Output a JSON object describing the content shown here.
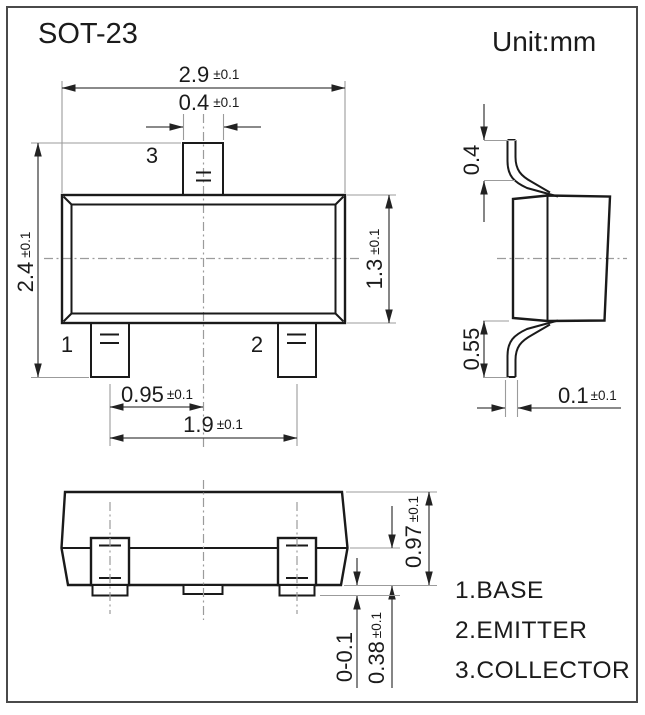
{
  "title": "SOT-23",
  "unit_label": "Unit:mm",
  "top_view": {
    "body_width": {
      "v": "2.9",
      "t": "±0.1"
    },
    "lead_width": {
      "v": "0.4",
      "t": "±0.1"
    },
    "total_height": {
      "v": "2.4",
      "t": "±0.1"
    },
    "body_height": {
      "v": "1.3",
      "t": "±0.1"
    },
    "lead_pitch": {
      "v": "0.95",
      "t": "±0.1"
    },
    "lead_span": {
      "v": "1.9",
      "t": "±0.1"
    },
    "pin1": "1",
    "pin2": "2",
    "pin3": "3"
  },
  "side_view": {
    "lead_top_height": "0.4",
    "lead_bottom_height": "0.55",
    "lead_thickness": {
      "v": "0.1",
      "t": "±0.1"
    }
  },
  "front_view": {
    "body_height": {
      "v": "0.97",
      "t": "±0.1"
    },
    "lead_shoulder": {
      "v": "0.38",
      "t": "±0.1"
    },
    "standoff": "0-0.1"
  },
  "legend": [
    "1.BASE",
    "2.EMITTER",
    "3.COLLECTOR"
  ],
  "colors": {
    "object_line": "#1a1a1a",
    "dimension_line": "#454545",
    "extension_line": "#9b9b9b",
    "text": "#1b1b1b",
    "background": "#ffffff"
  }
}
